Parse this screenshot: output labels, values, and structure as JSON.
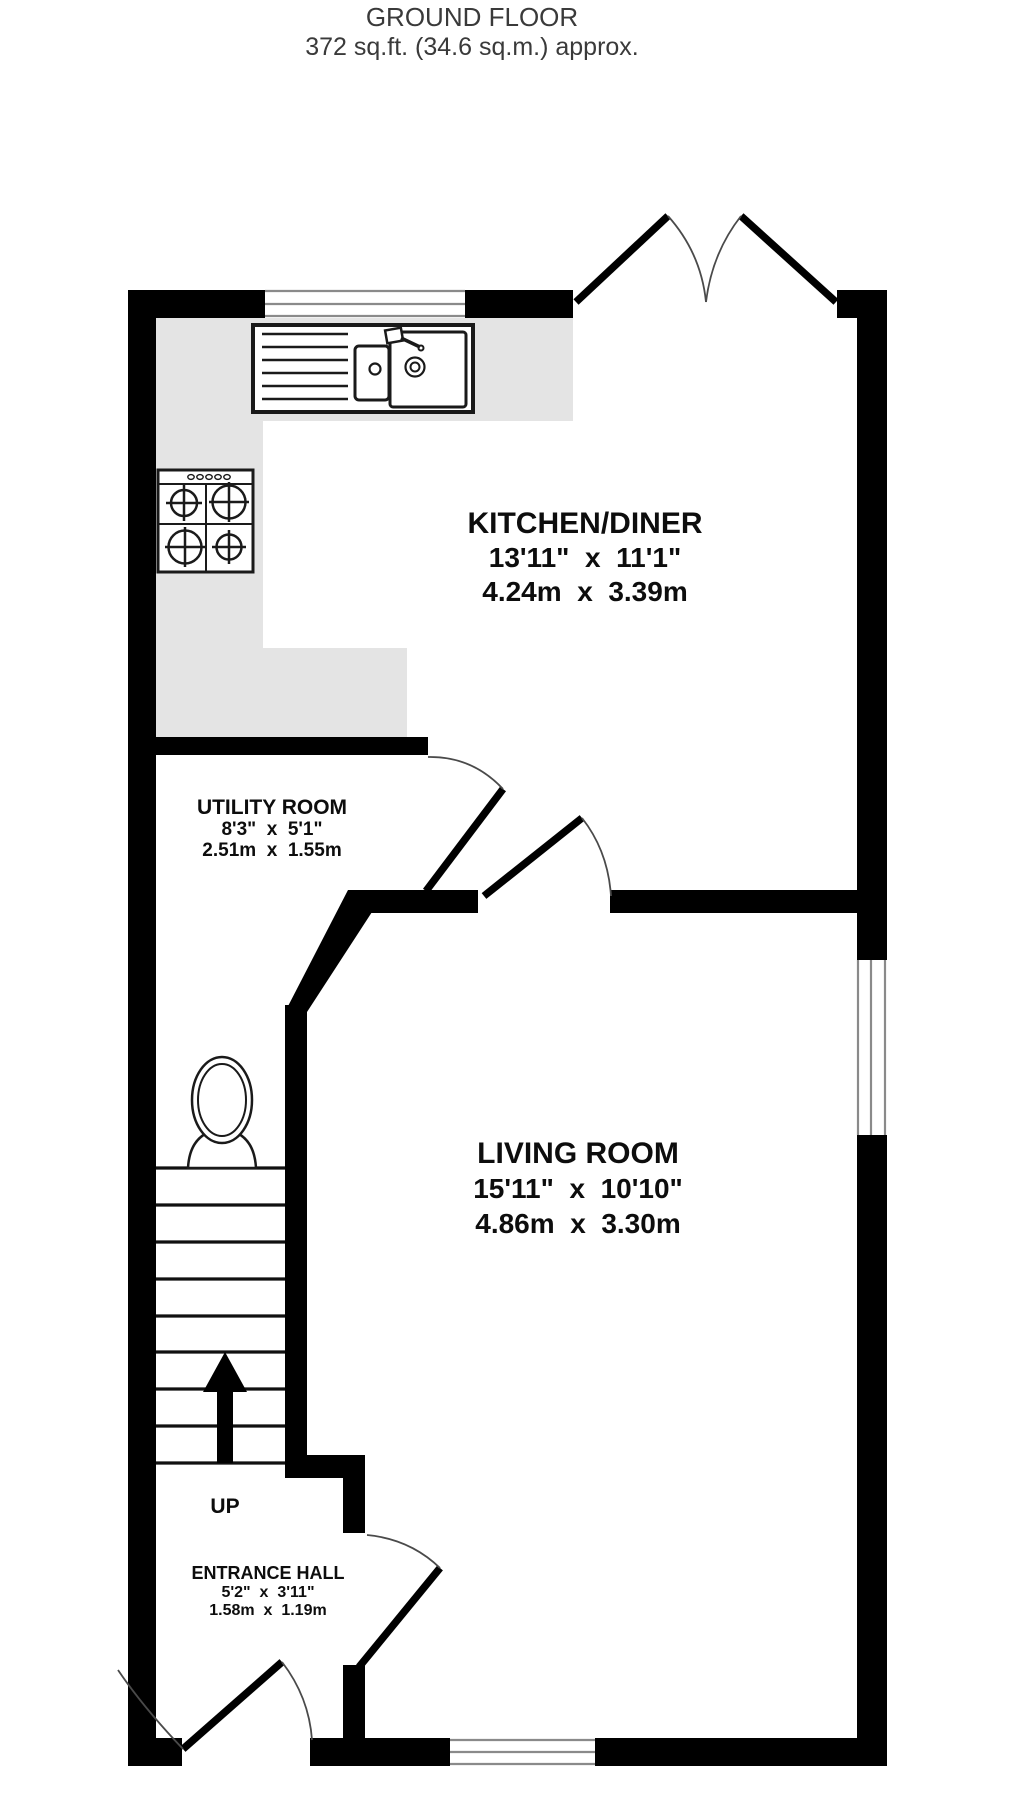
{
  "header": {
    "title": "GROUND FLOOR",
    "subtitle": "372 sq.ft. (34.6 sq.m.) approx."
  },
  "rooms": {
    "kitchen": {
      "name": "KITCHEN/DINER",
      "imperial": "13'11\"  x  11'1\"",
      "metric": "4.24m  x  3.39m"
    },
    "utility": {
      "name": "UTILITY ROOM",
      "imperial": "8'3\"  x  5'1\"",
      "metric": "2.51m  x  1.55m"
    },
    "living": {
      "name": "LIVING ROOM",
      "imperial": "15'11\"  x  10'10\"",
      "metric": "4.86m  x  3.30m"
    },
    "hall": {
      "name": "ENTRANCE HALL",
      "imperial": "5'2\"  x  3'11\"",
      "metric": "1.58m  x  1.19m"
    }
  },
  "stairs": {
    "direction_label": "UP"
  },
  "fixtures": [
    "sink-icon",
    "hob-icon",
    "toilet-icon",
    "up-arrow-icon"
  ],
  "colors": {
    "wall": "#000000",
    "counter": "#e4e4e4",
    "window_line": "#8a8a8a",
    "door_arc": "#4a4a4a",
    "title_text": "#3a3a3a",
    "label_text": "#0d0d0d",
    "fixture_line": "#1a1a1a"
  }
}
